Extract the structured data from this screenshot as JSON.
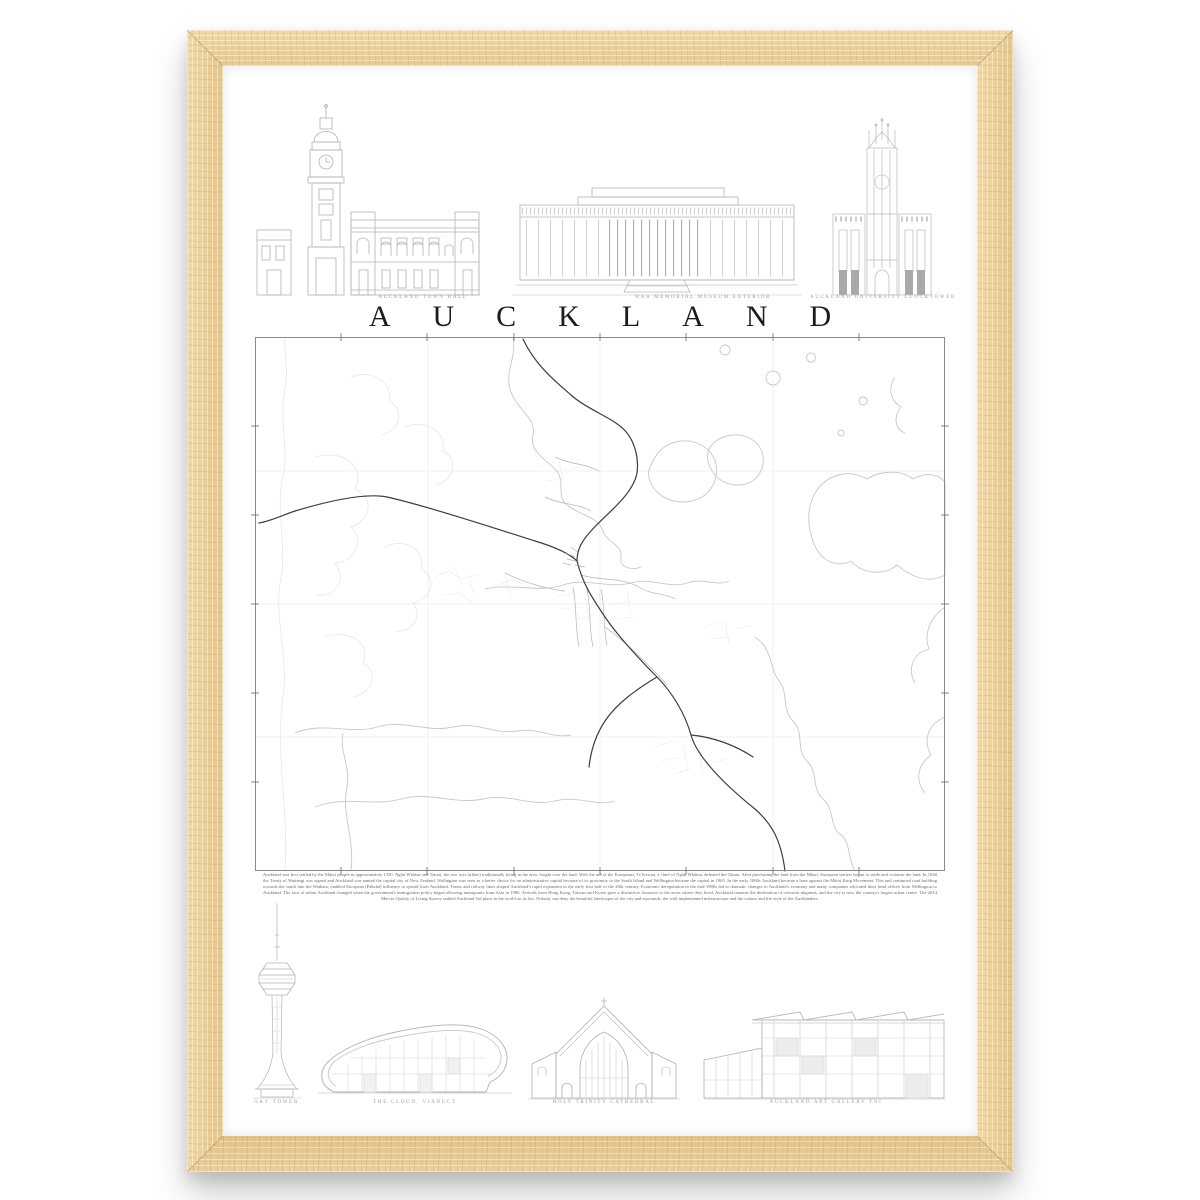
{
  "poster": {
    "title": "AUCKLAND",
    "top_buildings": [
      {
        "caption": "AUCKLAND TOWN HALL"
      },
      {
        "caption": "WAR MEMORIAL MUSEUM EXTERIOR"
      },
      {
        "caption": "AUCKLAND UNIVERSITY CLOCKTOWER"
      }
    ],
    "bottom_buildings": [
      {
        "caption": "SKY TOWER"
      },
      {
        "caption": "THE CLOUD, VIADUCT"
      },
      {
        "caption": "HOLY TRINITY CATHEDRAL"
      },
      {
        "caption": "AUCKLAND ART GALLERY TOI"
      }
    ],
    "description": "Auckland was first settled by the Māori people in approximately 1350. Ngāti Whātua and Tainui, the two iwis (tribes) traditionally living in the area, fought over the land. With the aid of the Europeans, Te Kawau, a chief of Ngāti Whātua, defeated the Tainui. After purchasing the land from the Māori, European settlers began to settle and colonise the land. In 1840 the Treaty of Waitangi was signed and Auckland was named the capital city of New Zealand. Wellington was seen as a better choice for an administrative capital because of its proximity to the South Island and Wellington became the capital in 1865. In the early 1860s Auckland became a base against the Māori King Movement. This and continued road building towards the south into the Waikato, enabled European (Pākehā) influence to spread from Auckland. Trams and railway lines shaped Auckland's rapid expansion in the early first half of the 20th century. Economic deregulation in the mid-1980s led to dramatic changes to Auckland's economy and many companies relocated their head offices from Wellington to Auckland. The face of urban Auckland changed when the government's immigration policy began allowing immigrants from Asia in 1986. Arrivals from Hong Kong, Taiwan and Korea gave a distinctive character to the areas where they lived. Auckland remains the destination of overseas migrants, and the city is now the country's largest urban centre. The 2014 Mercer Quality of Living Survey ranked Auckland 3rd place in the world on its list. Nobody can deny the beautiful landscapes of the city and surrounds, the well implemented infrastructure and the culture and life style of the Aucklanders.",
    "colors": {
      "frame_wood": "#e9cf9f",
      "drawing_line": "#b3b3b3",
      "map_coastline": "#c8c8c8",
      "motorway": "#3e3e3e",
      "title_text": "#1c1c1c",
      "caption_text": "#9b9b9b"
    }
  }
}
